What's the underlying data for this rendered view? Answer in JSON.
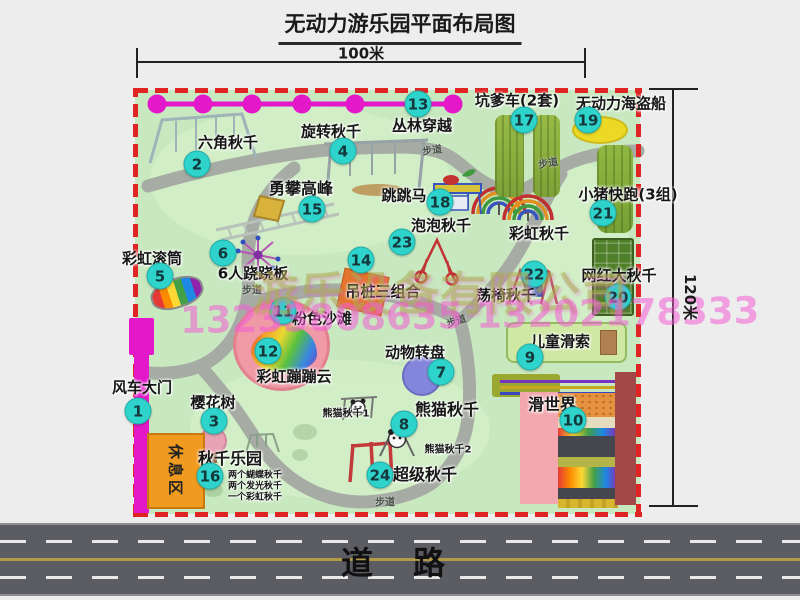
{
  "title": "无动力游乐园平面布局图",
  "dims": {
    "width_label": "100米",
    "height_label": "120米"
  },
  "road_label": "道　路",
  "trail_label": "步道",
  "rest_area_label": "休息区",
  "watermark": {
    "company": "游乐设备有限公司",
    "phone": "13233808635 13202178333"
  },
  "attractions": [
    {
      "num": "1",
      "name": "风车大门"
    },
    {
      "num": "2",
      "name": "六角秋千"
    },
    {
      "num": "3",
      "name": "樱花树"
    },
    {
      "num": "4",
      "name": "旋转秋千"
    },
    {
      "num": "5",
      "name": "彩虹滚筒"
    },
    {
      "num": "6",
      "name": "6人跷跷板"
    },
    {
      "num": "7",
      "name": "动物转盘"
    },
    {
      "num": "8",
      "name": "熊猫秋千"
    },
    {
      "num": "9",
      "name": "儿童滑索"
    },
    {
      "num": "10",
      "name": "滑世界"
    },
    {
      "num": "11",
      "name": "粉色沙滩"
    },
    {
      "num": "12",
      "name": "彩虹蹦蹦云"
    },
    {
      "num": "13",
      "name": "丛林穿越"
    },
    {
      "num": "14",
      "name": "吊桩三组合"
    },
    {
      "num": "15",
      "name": "勇攀高峰"
    },
    {
      "num": "16",
      "name": "秋千乐园"
    },
    {
      "num": "17",
      "name": "坑爹车(2套)"
    },
    {
      "num": "18",
      "name": "跳跳马"
    },
    {
      "num": "19",
      "name": "无动力海盗船"
    },
    {
      "num": "20",
      "name": "网红大秋千"
    },
    {
      "num": "21",
      "name": "小猪快跑(3组)"
    },
    {
      "num": "22",
      "name": "荡椅秋千"
    },
    {
      "num": "23",
      "name": "泡泡秋千"
    },
    {
      "num": "24",
      "name": "超级秋千"
    }
  ],
  "extra": {
    "rainbow_swing": "彩虹秋千",
    "panda_swing_1": "熊猫秋千1",
    "panda_swing_2": "熊猫秋千2"
  },
  "swing_park_items": [
    "两个蝴蝶秋千",
    "两个发光秋千",
    "一个彩虹秋千"
  ],
  "colors": {
    "map_green": "#c8e8bf",
    "border_red": "#e02424",
    "marker_teal": "#2ed3cb",
    "zipline_magenta": "#e318c8",
    "road_gray": "#5c5c63"
  }
}
